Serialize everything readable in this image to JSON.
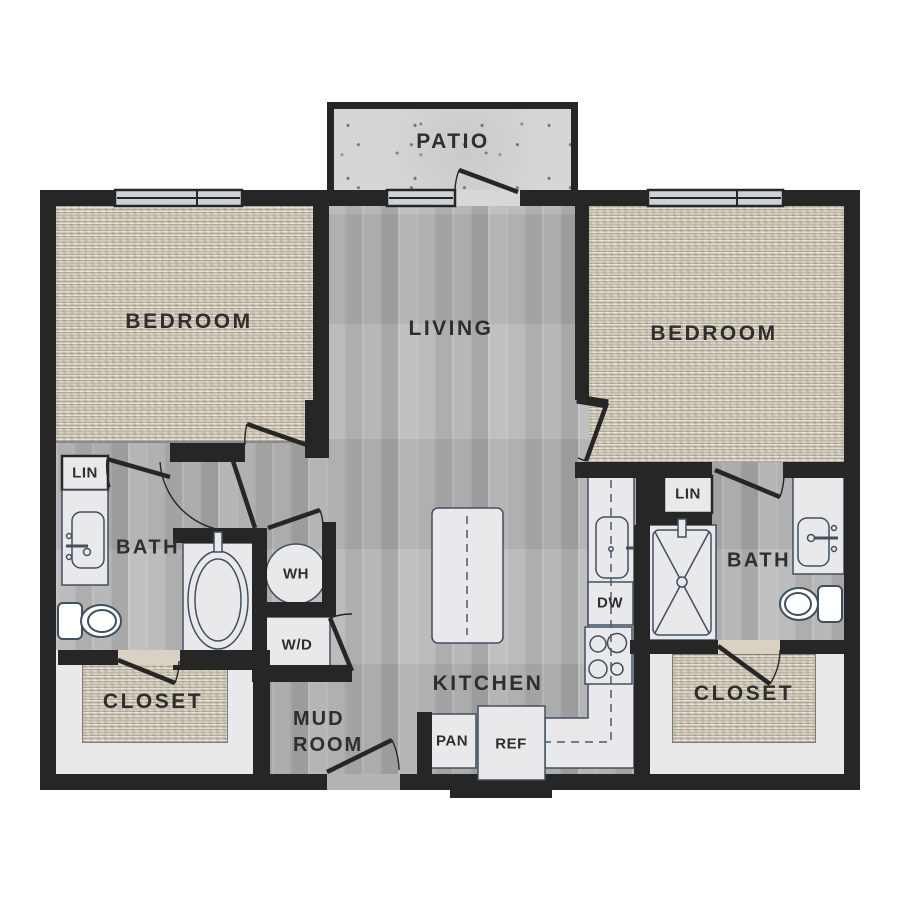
{
  "labels": {
    "patio": "PATIO",
    "bedroom_left": "BEDROOM",
    "living": "LIVING",
    "bedroom_right": "BEDROOM",
    "lin_left": "LIN",
    "bath_left": "BATH",
    "wh": "WH",
    "wd": "W/D",
    "closet_left": "CLOSET",
    "mud_room_line1": "MUD",
    "mud_room_line2": "ROOM",
    "kitchen": "KITCHEN",
    "pan": "PAN",
    "ref": "REF",
    "dw": "DW",
    "lin_right": "LIN",
    "bath_right": "BATH",
    "closet_right": "CLOSET"
  },
  "colors": {
    "wall": "#262626",
    "wood": "#b1b1b1",
    "carpet": "#d9d2c3",
    "concrete": "#d6d6d6",
    "fixture": "#e9e9ec",
    "surround": "#e9e9ec",
    "outline": "#3f5060",
    "dash": "#4a5a6d",
    "window": "#cdd2d7",
    "label_text": "#2e2e2e"
  }
}
